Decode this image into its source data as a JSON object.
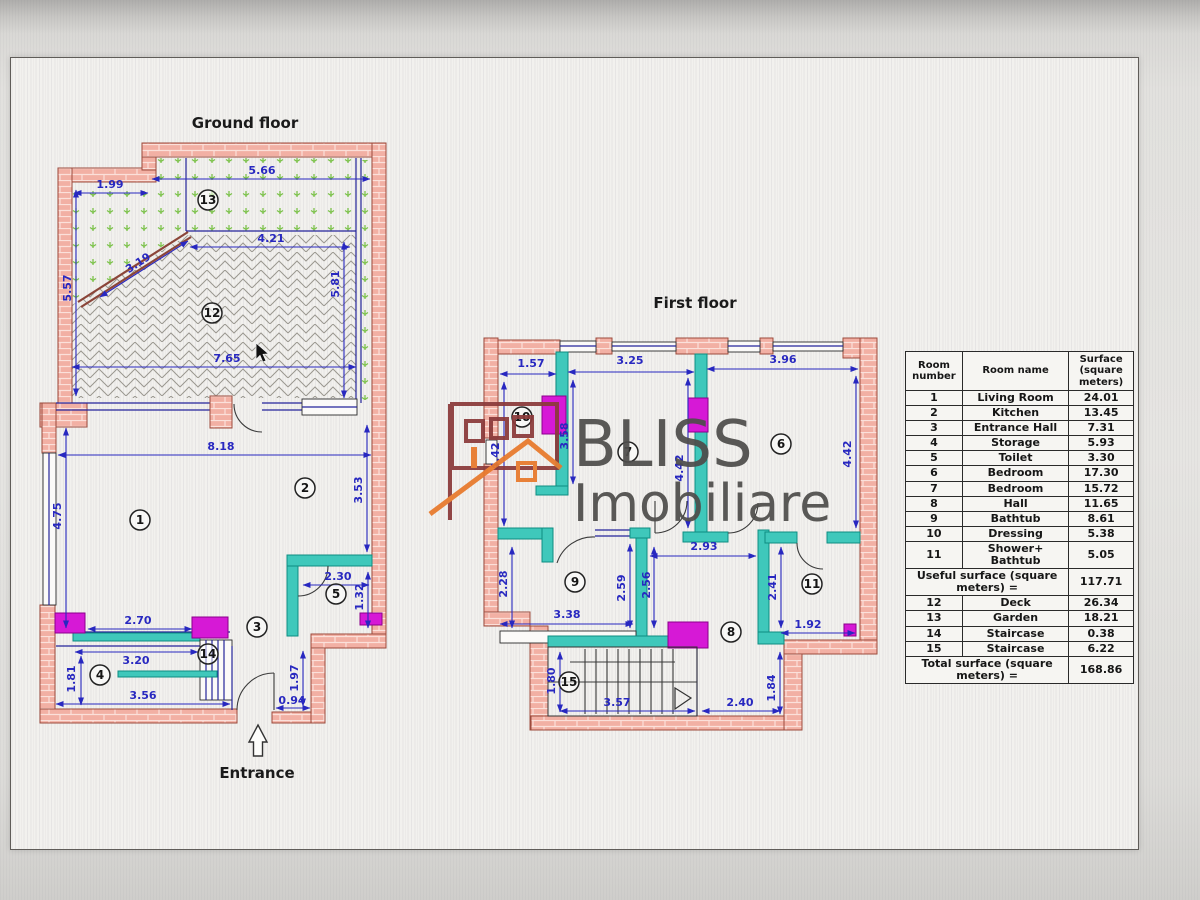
{
  "titles": {
    "ground": "Ground floor",
    "first": "First floor",
    "entrance": "Entrance"
  },
  "brand": {
    "name": "BLISS",
    "tagline": "Imobiliare"
  },
  "ground_floor": {
    "room_numbers": [
      "13",
      "12",
      "1",
      "2",
      "3",
      "4",
      "5",
      "14"
    ],
    "dimensions": [
      "1.99",
      "5.66",
      "4.21",
      "3.19",
      "5.57",
      "5.81",
      "7.65",
      "8.18",
      "4.75",
      "3.53",
      "2.30",
      "1.32",
      "2.70",
      "3.20",
      "1.81",
      "3.56",
      "0.94",
      "1.97"
    ]
  },
  "first_floor": {
    "room_numbers": [
      "10",
      "7",
      "6",
      "9",
      "8",
      "11",
      "15"
    ],
    "dimensions": [
      "1.57",
      "3.25",
      "3.96",
      "4.42",
      "3.58",
      "4.42",
      "4.42",
      "2.93",
      "2.28",
      "2.59",
      "2.56",
      "3.38",
      "2.41",
      "1.92",
      "1.80",
      "3.57",
      "2.40",
      "1.84"
    ]
  },
  "table": {
    "headers": [
      "Room number",
      "Room name",
      "Surface (square meters)"
    ],
    "rows_upper": [
      [
        "1",
        "Living Room",
        "24.01"
      ],
      [
        "2",
        "Kitchen",
        "13.45"
      ],
      [
        "3",
        "Entrance Hall",
        "7.31"
      ],
      [
        "4",
        "Storage",
        "5.93"
      ],
      [
        "5",
        "Toilet",
        "3.30"
      ],
      [
        "6",
        "Bedroom",
        "17.30"
      ],
      [
        "7",
        "Bedroom",
        "15.72"
      ],
      [
        "8",
        "Hall",
        "11.65"
      ],
      [
        "9",
        "Bathtub",
        "8.61"
      ],
      [
        "10",
        "Dressing",
        "5.38"
      ],
      [
        "11",
        "Shower+ Bathtub",
        "5.05"
      ]
    ],
    "useful_label": "Useful surface (square meters) =",
    "useful_value": "117.71",
    "rows_lower": [
      [
        "12",
        "Deck",
        "26.34"
      ],
      [
        "13",
        "Garden",
        "18.21"
      ],
      [
        "14",
        "Staircase",
        "0.38"
      ],
      [
        "15",
        "Staircase",
        "6.22"
      ]
    ],
    "total_label": "Total surface (square meters) =",
    "total_value": "168.86"
  },
  "colors": {
    "brick": "#f2b0a4",
    "teal": "#3fc8bb",
    "magenta": "#d619d6",
    "dimension_blue": "#2828c0",
    "garden_green": "#7cc24a",
    "logo_orange": "#e8792b",
    "logo_darkred": "#8b3a3a"
  }
}
